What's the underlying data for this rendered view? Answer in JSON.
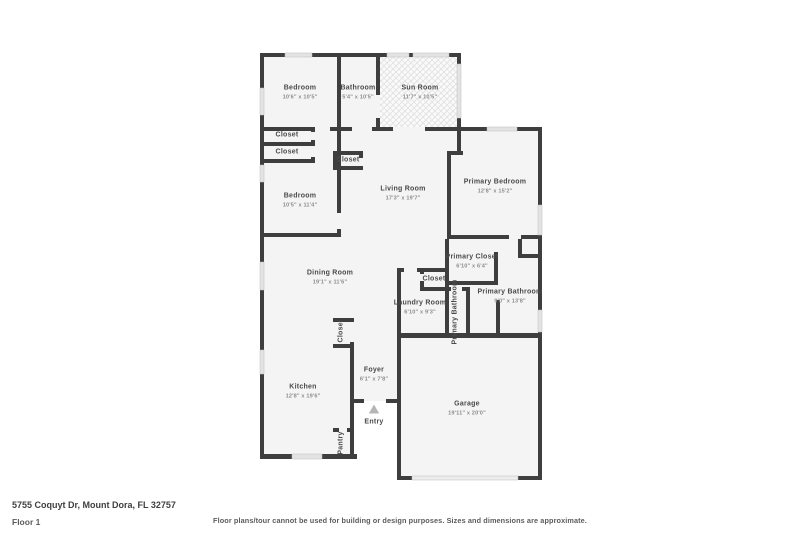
{
  "footer": {
    "address": "5755 Coquyt Dr, Mount Dora, FL 32757",
    "floor_label": "Floor 1",
    "disclaimer": "Floor plans/tour cannot be used for building or design purposes. Sizes and dimensions are approximate."
  },
  "floorplan": {
    "colors": {
      "room_fill": "#f4f4f4",
      "wall": "#3e3e3e",
      "window_fill": "#e3e3e3",
      "window_stroke": "#bdbdbd",
      "garage_door_fill": "#ececec",
      "hatch_base": "#fafafa",
      "hatch_line": "#dedede",
      "label_color": "#4a4a4a",
      "dims_color": "#8d8d8d",
      "entry_arrow": "#b5b5b5"
    },
    "rooms": [
      {
        "slug": "bedroom-top",
        "name": "Bedroom",
        "dims": "10'6\" x 10'5\"",
        "x": 300,
        "y": 93,
        "rot": 0
      },
      {
        "slug": "bathroom",
        "name": "Bathroom",
        "dims": "5'4\" x 10'5\"",
        "x": 358,
        "y": 93,
        "rot": 0
      },
      {
        "slug": "sun-room",
        "name": "Sun Room",
        "dims": "11'7\" x 10'5\"",
        "x": 420,
        "y": 93,
        "rot": 0
      },
      {
        "slug": "closet-1",
        "name": "Closet",
        "dims": "",
        "x": 287,
        "y": 136,
        "rot": 0
      },
      {
        "slug": "closet-2",
        "name": "Closet",
        "dims": "",
        "x": 287,
        "y": 153,
        "rot": 0
      },
      {
        "slug": "closet-living",
        "name": "Closet",
        "dims": "",
        "x": 348,
        "y": 161,
        "rot": 0
      },
      {
        "slug": "bedroom-left",
        "name": "Bedroom",
        "dims": "10'5\" x 11'4\"",
        "x": 300,
        "y": 201,
        "rot": 0
      },
      {
        "slug": "living-room",
        "name": "Living Room",
        "dims": "17'3\" x 19'7\"",
        "x": 403,
        "y": 194,
        "rot": 0
      },
      {
        "slug": "primary-bedroom",
        "name": "Primary Bedroom",
        "dims": "12'8\" x 15'2\"",
        "x": 495,
        "y": 187,
        "rot": 0
      },
      {
        "slug": "dining-room",
        "name": "Dining Room",
        "dims": "19'1\" x 11'6\"",
        "x": 330,
        "y": 278,
        "rot": 0
      },
      {
        "slug": "primary-closet",
        "name": "Primary Closet",
        "dims": "6'10\" x 6'4\"",
        "x": 472,
        "y": 262,
        "rot": 0
      },
      {
        "slug": "closet-hall",
        "name": "Closet",
        "dims": "",
        "x": 434,
        "y": 280,
        "rot": 0
      },
      {
        "slug": "laundry-room",
        "name": "Laundry Room",
        "dims": "6'10\" x 9'3\"",
        "x": 420,
        "y": 308,
        "rot": 0
      },
      {
        "slug": "primary-bathroom-wc",
        "name": "Primary Bathroom",
        "dims": "",
        "x": 456,
        "y": 312,
        "rot": -90
      },
      {
        "slug": "primary-bathroom",
        "name": "Primary Bathroom",
        "dims": "9'0\" x 13'8\"",
        "x": 510,
        "y": 297,
        "rot": 0
      },
      {
        "slug": "closet-foyer",
        "name": "Closet",
        "dims": "",
        "x": 342,
        "y": 331,
        "rot": -90
      },
      {
        "slug": "foyer",
        "name": "Foyer",
        "dims": "6'1\" x 7'8\"",
        "x": 374,
        "y": 375,
        "rot": 0
      },
      {
        "slug": "kitchen",
        "name": "Kitchen",
        "dims": "12'8\" x 19'6\"",
        "x": 303,
        "y": 392,
        "rot": 0
      },
      {
        "slug": "entry",
        "name": "Entry",
        "dims": "",
        "x": 374,
        "y": 423,
        "rot": 0
      },
      {
        "slug": "garage",
        "name": "Garage",
        "dims": "19'11\" x 20'0\"",
        "x": 467,
        "y": 409,
        "rot": 0
      },
      {
        "slug": "pantry",
        "name": "Pantry",
        "dims": "",
        "x": 342,
        "y": 443,
        "rot": -90
      }
    ]
  }
}
